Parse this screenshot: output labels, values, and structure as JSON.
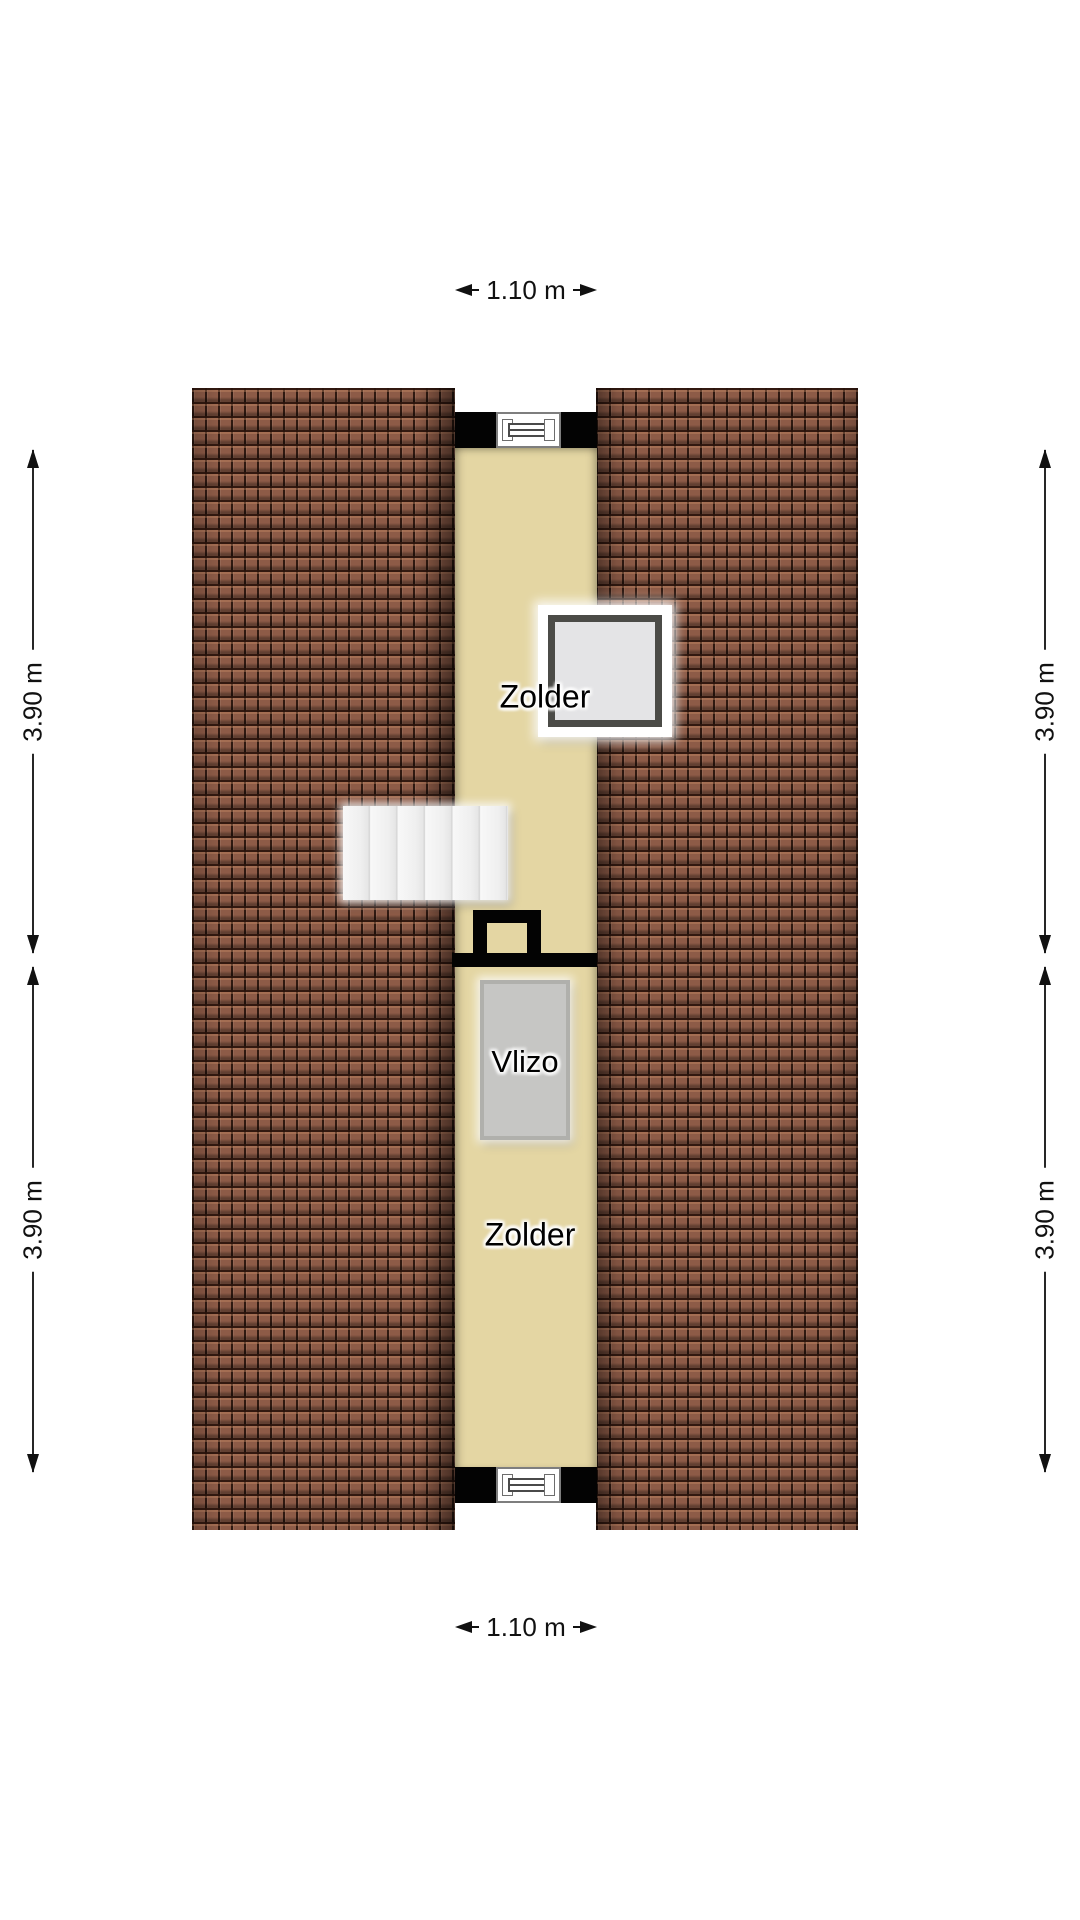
{
  "rooms": {
    "zolder_upper": {
      "label": "Zolder"
    },
    "vlizo": {
      "label": "Vlizo"
    },
    "zolder_lower": {
      "label": "Zolder"
    }
  },
  "dimensions": {
    "top_width": "1.10 m",
    "bottom_width": "1.10 m",
    "left_upper": "3.90 m",
    "left_lower": "3.90 m",
    "right_upper": "3.90 m",
    "right_lower": "3.90 m"
  },
  "colors": {
    "roof_tile": "#8d5b47",
    "roof_tile_shadow": "#2a130b",
    "floor": "#e4d6a3",
    "wall": "#030303",
    "stairs": "#f0f0f0",
    "skylight_frame": "#4b4b47",
    "skylight_glass": "#e4e4e6",
    "vlizo_fill": "#c6c6c4",
    "vlizo_border": "#b0b0ac",
    "dimension_line": "#111111"
  }
}
